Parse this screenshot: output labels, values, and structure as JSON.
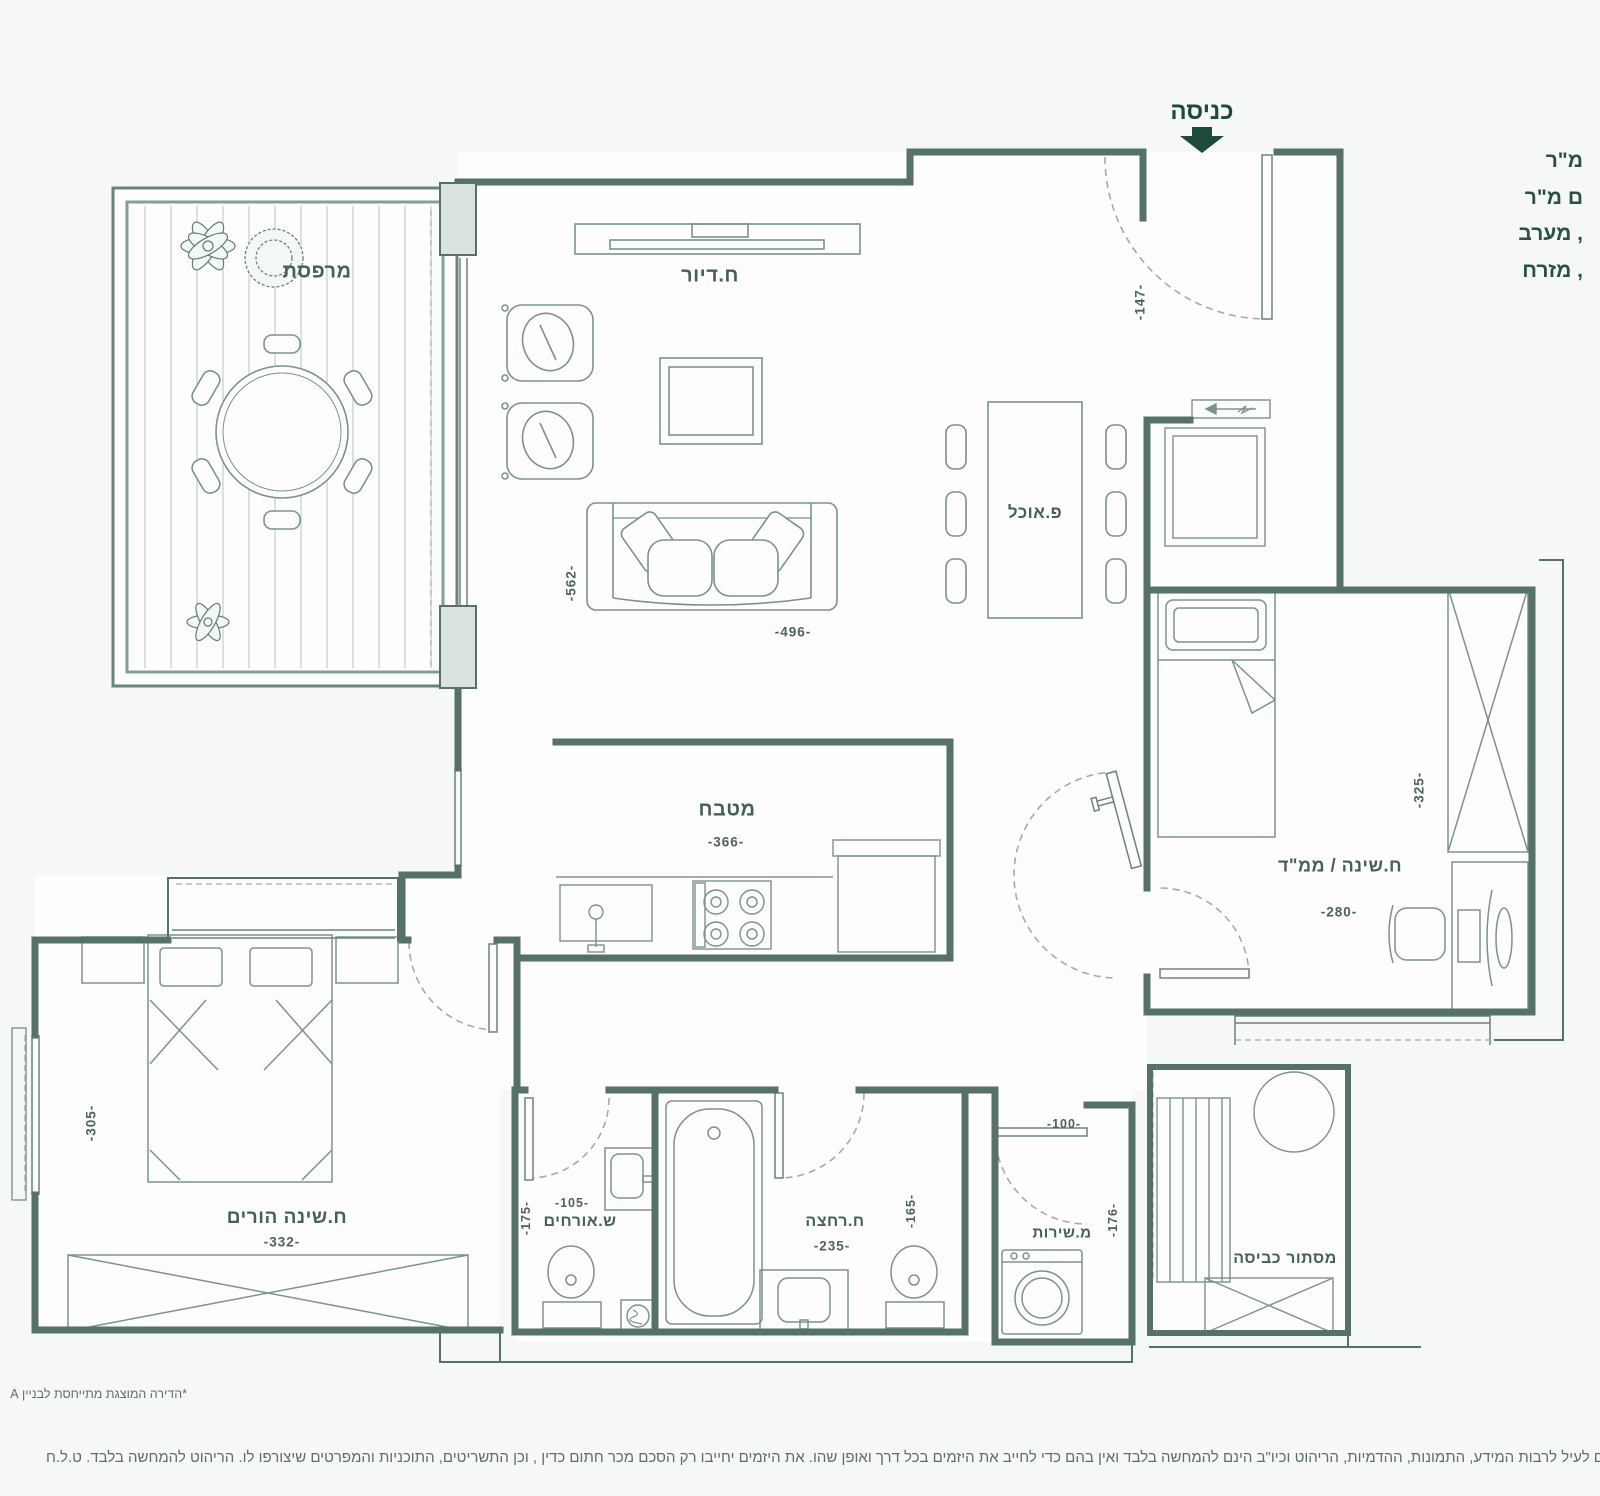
{
  "entrance": {
    "label": "כניסה",
    "dim": "-147-"
  },
  "side_text": {
    "lines": [
      "מ\"ר",
      "ם מ\"ר",
      ", מערב",
      ", מזרח"
    ]
  },
  "rooms": {
    "balcony": {
      "label": "מרפסת"
    },
    "living": {
      "label": "ח.דיור",
      "dim_w": "-496-",
      "dim_h": "-562-"
    },
    "dining": {
      "label": "פ.אוכל"
    },
    "kitchen": {
      "label": "מטבח",
      "dim_w": "-366-"
    },
    "safe_bedroom": {
      "label": "ח.שינה / ממ\"ד",
      "dim_w": "-280-",
      "dim_h": "-325-"
    },
    "parents_bedroom": {
      "label": "ח.שינה הורים",
      "dim_w": "-332-",
      "dim_h": "-305-"
    },
    "guest_wc": {
      "label": "ש.אורחים",
      "dim_w": "-105-",
      "dim_h": "-175-"
    },
    "bathroom": {
      "label": "ח.רחצה",
      "dim_w": "-235-",
      "dim_h": "-165-"
    },
    "service_wc": {
      "label": "מ.שירות",
      "dim_w": "-100-",
      "dim_h": "-176-"
    },
    "laundry": {
      "label": "מסתור כביסה"
    }
  },
  "footer": {
    "note": "*הדירה המוצגת מתייחסת לבניין A",
    "disclaimer": "ם לעיל לרבות המידע, התמונות, ההדמיות, הריהוט וכיו\"ב הינם להמחשה בלבד ואין בהם כדי לחייב את היזמים בכל דרך ואופן שהו. את היזמים יחייבו רק הסכם מכר חתום כדין , וכן התשריטים, התוכניות והמפרטים שיצורפו לו. הריהוט להמחשה בלבד. ט.ל.ח"
  },
  "colors": {
    "wall": "#56706a",
    "accent": "#1d4a3d",
    "rail": "#7fa294",
    "arc": "#b3a6a1"
  }
}
